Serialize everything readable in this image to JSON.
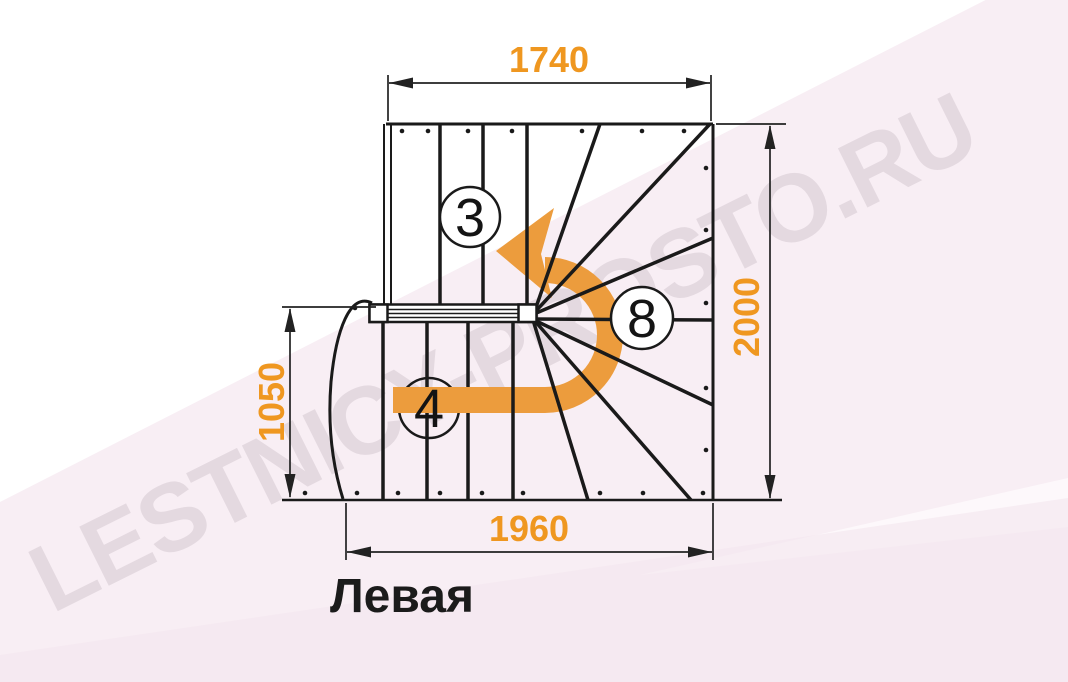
{
  "drawing": {
    "type": "staircase-floor-plan",
    "title": "Левая",
    "watermark": "LESTNICY-PROSTO.RU"
  },
  "dimensions": {
    "top_width_mm": "1740",
    "right_height_mm": "2000",
    "left_height_mm": "1050",
    "bottom_width_mm": "1960"
  },
  "flights": {
    "upper_straight_steps": "3",
    "winder_steps": "8",
    "lower_straight_steps": "4"
  },
  "colors": {
    "dimension_text": "#EF9720",
    "arrow": "#EC9C3D",
    "line": "#1A1A1A",
    "background_tint": "#F8EEF4"
  }
}
